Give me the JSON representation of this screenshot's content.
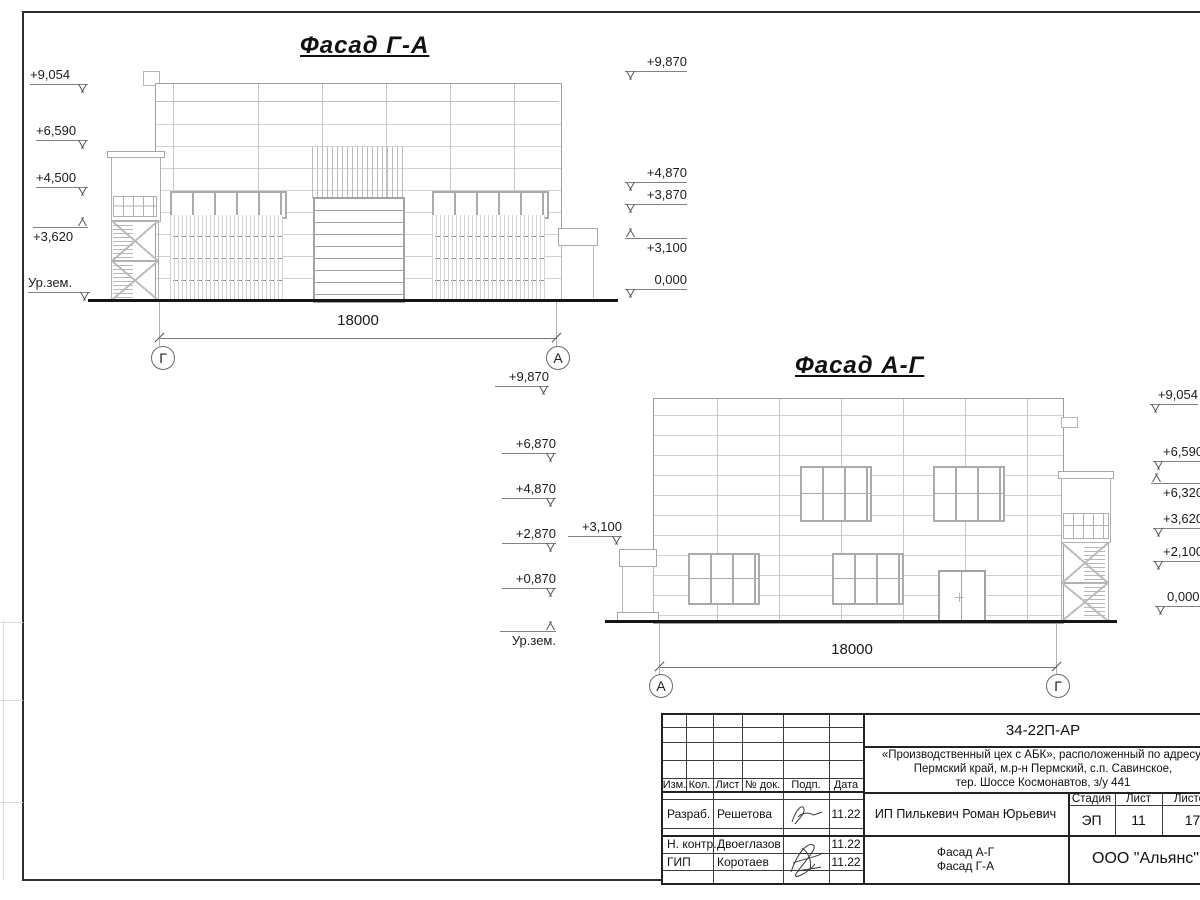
{
  "drawing": {
    "facade_ga": {
      "title": "Фасад Г-А",
      "left_marks": [
        "+9,054",
        "+6,590",
        "+4,500",
        "+3,620",
        "Ур.зем."
      ],
      "right_marks": [
        "+9,870",
        "+4,870",
        "+3,870",
        "+3,100",
        "0,000"
      ],
      "dimension": "18000",
      "axis_left": "Г",
      "axis_right": "А"
    },
    "facade_ag": {
      "title": "Фасад А-Г",
      "left_marks": [
        "+9,870",
        "+6,870",
        "+4,870",
        "+2,870",
        "+0,870",
        "Ур.зем."
      ],
      "canopy_mark": "+3,100",
      "right_marks": [
        "+9,054",
        "+6,590",
        "+6,320",
        "+3,620",
        "+2,100",
        "0,000"
      ],
      "dimension": "18000",
      "axis_left": "А",
      "axis_right": "Г"
    }
  },
  "title_block": {
    "doc_code": "34-22П-АР",
    "address_line1": "«Производственный цех с АБК», расположенный по адресу:",
    "address_line2": "Пермский край, м.р-н Пермский, с.п. Савинское,",
    "address_line3": "тер. Шоссе Космонавтов, з/у 441",
    "headers": {
      "izm": "Изм.",
      "kol": "Кол.",
      "list": "Лист",
      "doc": "№ док.",
      "podp": "Подп.",
      "data": "Дата"
    },
    "rows": [
      {
        "role": "Разраб.",
        "name": "Решетова",
        "date": "11.22"
      },
      {
        "role": "Н. контр.",
        "name": "Двоеглазов",
        "date": "11.22"
      },
      {
        "role": "ГИП",
        "name": "Коротаев",
        "date": "11.22"
      }
    ],
    "client": "ИП Пилькевич Роман Юрьевич",
    "stage_label": "Стадия",
    "sheet_label": "Лист",
    "sheets_label": "Листов",
    "stage": "ЭП",
    "sheet_no": "11",
    "sheets_total": "17",
    "drawing_title_line1": "Фасад А-Г",
    "drawing_title_line2": "Фасад Г-А",
    "company": "ООО \"Альянс\""
  }
}
